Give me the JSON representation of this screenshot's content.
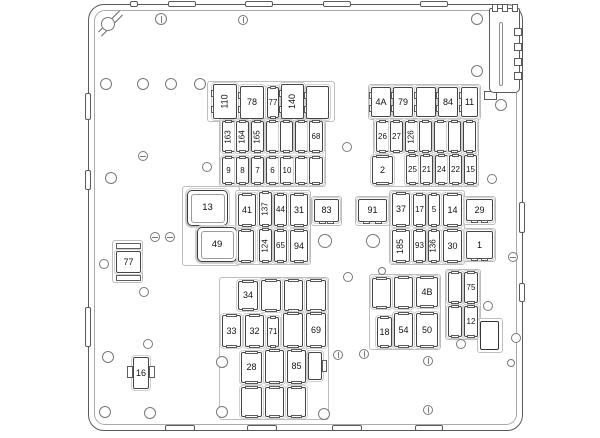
{
  "diagram": {
    "type": "fuse-box-layout",
    "canvas": {
      "width": 600,
      "height": 438
    },
    "colors": {
      "background": "#ffffff",
      "frame_stroke": "#5a5a5a",
      "frame_inner_stroke": "#a9a9a9",
      "fuse_stroke": "#454545",
      "holder_stroke": "#cfcfcf",
      "label_text": "#111111"
    },
    "frame": {
      "x": 88,
      "y": 4,
      "w": 435,
      "h": 427,
      "radius": 16
    },
    "fuse_labels_visible": [
      "110",
      "78",
      "77",
      "140",
      "163",
      "164",
      "165",
      "68",
      "9",
      "8",
      "7",
      "6",
      "10",
      "4A",
      "79",
      "84",
      "11",
      "26",
      "27",
      "126",
      "2",
      "25",
      "21",
      "24",
      "22",
      "15",
      "13",
      "41",
      "137",
      "44",
      "31",
      "83",
      "91",
      "37",
      "17",
      "5",
      "14",
      "29",
      "49",
      "124",
      "65",
      "94",
      "185",
      "93",
      "136",
      "30",
      "1",
      "77",
      "16",
      "34",
      "33",
      "32",
      "71",
      "69",
      "28",
      "85",
      "4B",
      "18",
      "54",
      "50",
      "75",
      "12"
    ],
    "fuses": [
      {
        "l": "110",
        "x": 213,
        "y": 84,
        "w": 24,
        "h": 35,
        "k": "relay",
        "r": 1
      },
      {
        "l": "78",
        "x": 240,
        "y": 86,
        "w": 24,
        "h": 33,
        "k": "relay"
      },
      {
        "l": "77",
        "x": 267,
        "y": 87,
        "w": 12,
        "h": 31,
        "k": "mini"
      },
      {
        "l": "140",
        "x": 281,
        "y": 84,
        "w": 23,
        "h": 35,
        "k": "relay",
        "r": 1
      },
      {
        "l": "",
        "x": 306,
        "y": 86,
        "w": 23,
        "h": 33,
        "k": "relay"
      },
      {
        "l": "163",
        "x": 222,
        "y": 121,
        "w": 13,
        "h": 31,
        "k": "mini",
        "r": 1
      },
      {
        "l": "164",
        "x": 236,
        "y": 121,
        "w": 13,
        "h": 31,
        "k": "mini",
        "r": 1
      },
      {
        "l": "165",
        "x": 251,
        "y": 121,
        "w": 13,
        "h": 31,
        "k": "mini",
        "r": 1
      },
      {
        "l": "",
        "x": 266,
        "y": 121,
        "w": 13,
        "h": 31,
        "k": "mini"
      },
      {
        "l": "",
        "x": 280,
        "y": 121,
        "w": 13,
        "h": 31,
        "k": "mini"
      },
      {
        "l": "",
        "x": 295,
        "y": 121,
        "w": 13,
        "h": 31,
        "k": "mini"
      },
      {
        "l": "68",
        "x": 309,
        "y": 121,
        "w": 14,
        "h": 31,
        "k": "mini"
      },
      {
        "l": "9",
        "x": 222,
        "y": 157,
        "w": 13,
        "h": 27,
        "k": "mini"
      },
      {
        "l": "8",
        "x": 236,
        "y": 157,
        "w": 13,
        "h": 27,
        "k": "mini"
      },
      {
        "l": "7",
        "x": 251,
        "y": 157,
        "w": 13,
        "h": 27,
        "k": "mini"
      },
      {
        "l": "6",
        "x": 266,
        "y": 157,
        "w": 13,
        "h": 27,
        "k": "mini"
      },
      {
        "l": "10",
        "x": 280,
        "y": 157,
        "w": 14,
        "h": 27,
        "k": "mini"
      },
      {
        "l": "",
        "x": 295,
        "y": 157,
        "w": 13,
        "h": 27,
        "k": "mini"
      },
      {
        "l": "",
        "x": 309,
        "y": 157,
        "w": 14,
        "h": 27,
        "k": "mini"
      },
      {
        "l": "4A",
        "x": 371,
        "y": 87,
        "w": 20,
        "h": 30,
        "k": "relay"
      },
      {
        "l": "79",
        "x": 393,
        "y": 87,
        "w": 20,
        "h": 30,
        "k": "relay"
      },
      {
        "l": "",
        "x": 416,
        "y": 87,
        "w": 20,
        "h": 30,
        "k": "relay"
      },
      {
        "l": "84",
        "x": 438,
        "y": 87,
        "w": 20,
        "h": 30,
        "k": "relay"
      },
      {
        "l": "11",
        "x": 461,
        "y": 87,
        "w": 17,
        "h": 30,
        "k": "relay"
      },
      {
        "l": "26",
        "x": 376,
        "y": 121,
        "w": 13,
        "h": 31,
        "k": "mini"
      },
      {
        "l": "27",
        "x": 390,
        "y": 121,
        "w": 13,
        "h": 31,
        "k": "mini"
      },
      {
        "l": "126",
        "x": 405,
        "y": 121,
        "w": 13,
        "h": 31,
        "k": "mini",
        "r": 1
      },
      {
        "l": "",
        "x": 419,
        "y": 121,
        "w": 13,
        "h": 31,
        "k": "mini"
      },
      {
        "l": "",
        "x": 434,
        "y": 121,
        "w": 13,
        "h": 31,
        "k": "mini"
      },
      {
        "l": "",
        "x": 448,
        "y": 121,
        "w": 13,
        "h": 31,
        "k": "mini"
      },
      {
        "l": "",
        "x": 463,
        "y": 121,
        "w": 13,
        "h": 31,
        "k": "mini"
      },
      {
        "l": "2",
        "x": 372,
        "y": 156,
        "w": 21,
        "h": 28,
        "k": "med"
      },
      {
        "l": "25",
        "x": 406,
        "y": 155,
        "w": 13,
        "h": 29,
        "k": "mini"
      },
      {
        "l": "21",
        "x": 420,
        "y": 155,
        "w": 13,
        "h": 29,
        "k": "mini"
      },
      {
        "l": "24",
        "x": 435,
        "y": 155,
        "w": 13,
        "h": 29,
        "k": "mini"
      },
      {
        "l": "22",
        "x": 449,
        "y": 155,
        "w": 13,
        "h": 29,
        "k": "mini"
      },
      {
        "l": "15",
        "x": 464,
        "y": 155,
        "w": 13,
        "h": 29,
        "k": "mini"
      },
      {
        "l": "13",
        "x": 187,
        "y": 190,
        "w": 41,
        "h": 36,
        "k": "big"
      },
      {
        "l": "41",
        "x": 238,
        "y": 194,
        "w": 18,
        "h": 32,
        "k": "med"
      },
      {
        "l": "137",
        "x": 259,
        "y": 192,
        "w": 13,
        "h": 34,
        "k": "mini",
        "r": 1
      },
      {
        "l": "44",
        "x": 274,
        "y": 194,
        "w": 13,
        "h": 32,
        "k": "mini"
      },
      {
        "l": "31",
        "x": 290,
        "y": 194,
        "w": 18,
        "h": 32,
        "k": "med"
      },
      {
        "l": "83",
        "x": 314,
        "y": 199,
        "w": 25,
        "h": 23,
        "k": "hrelay"
      },
      {
        "l": "91",
        "x": 358,
        "y": 199,
        "w": 29,
        "h": 23,
        "k": "hrelay"
      },
      {
        "l": "37",
        "x": 392,
        "y": 193,
        "w": 18,
        "h": 33,
        "k": "med"
      },
      {
        "l": "17",
        "x": 413,
        "y": 194,
        "w": 13,
        "h": 32,
        "k": "mini"
      },
      {
        "l": "5",
        "x": 428,
        "y": 194,
        "w": 12,
        "h": 32,
        "k": "mini"
      },
      {
        "l": "14",
        "x": 443,
        "y": 194,
        "w": 19,
        "h": 32,
        "k": "med"
      },
      {
        "l": "29",
        "x": 466,
        "y": 199,
        "w": 27,
        "h": 22,
        "k": "hrelay"
      },
      {
        "l": "49",
        "x": 197,
        "y": 227,
        "w": 40,
        "h": 35,
        "k": "big"
      },
      {
        "l": "",
        "x": 238,
        "y": 230,
        "w": 16,
        "h": 32,
        "k": "med"
      },
      {
        "l": "124",
        "x": 259,
        "y": 229,
        "w": 13,
        "h": 33,
        "k": "mini",
        "r": 1
      },
      {
        "l": "65",
        "x": 274,
        "y": 230,
        "w": 13,
        "h": 32,
        "k": "mini"
      },
      {
        "l": "94",
        "x": 290,
        "y": 230,
        "w": 18,
        "h": 32,
        "k": "med"
      },
      {
        "l": "185",
        "x": 392,
        "y": 230,
        "w": 18,
        "h": 32,
        "k": "med",
        "r": 1
      },
      {
        "l": "93",
        "x": 413,
        "y": 230,
        "w": 13,
        "h": 32,
        "k": "mini"
      },
      {
        "l": "136",
        "x": 428,
        "y": 230,
        "w": 12,
        "h": 32,
        "k": "mini",
        "r": 1
      },
      {
        "l": "30",
        "x": 443,
        "y": 230,
        "w": 19,
        "h": 32,
        "k": "med"
      },
      {
        "l": "1",
        "x": 466,
        "y": 231,
        "w": 27,
        "h": 28,
        "k": "hrelay"
      },
      {
        "l": "77",
        "x": 116,
        "y": 251,
        "w": 25,
        "h": 22,
        "k": "plain"
      },
      {
        "l": "16",
        "x": 133,
        "y": 357,
        "w": 16,
        "h": 32,
        "k": "plain"
      },
      {
        "l": "34",
        "x": 238,
        "y": 281,
        "w": 20,
        "h": 29,
        "k": "med"
      },
      {
        "l": "",
        "x": 261,
        "y": 280,
        "w": 20,
        "h": 31,
        "k": "med"
      },
      {
        "l": "",
        "x": 284,
        "y": 280,
        "w": 19,
        "h": 31,
        "k": "med"
      },
      {
        "l": "",
        "x": 306,
        "y": 280,
        "w": 20,
        "h": 31,
        "k": "med"
      },
      {
        "l": "33",
        "x": 222,
        "y": 315,
        "w": 19,
        "h": 32,
        "k": "med"
      },
      {
        "l": "32",
        "x": 245,
        "y": 315,
        "w": 19,
        "h": 32,
        "k": "med"
      },
      {
        "l": "71",
        "x": 267,
        "y": 317,
        "w": 12,
        "h": 30,
        "k": "mini"
      },
      {
        "l": "",
        "x": 283,
        "y": 313,
        "w": 20,
        "h": 34,
        "k": "med"
      },
      {
        "l": "69",
        "x": 306,
        "y": 313,
        "w": 20,
        "h": 34,
        "k": "med"
      },
      {
        "l": "28",
        "x": 241,
        "y": 352,
        "w": 21,
        "h": 31,
        "k": "med"
      },
      {
        "l": "",
        "x": 265,
        "y": 350,
        "w": 19,
        "h": 33,
        "k": "med"
      },
      {
        "l": "85",
        "x": 287,
        "y": 350,
        "w": 19,
        "h": 33,
        "k": "med"
      },
      {
        "l": "",
        "x": 308,
        "y": 352,
        "w": 14,
        "h": 28,
        "k": "plain"
      },
      {
        "l": "",
        "x": 241,
        "y": 387,
        "w": 21,
        "h": 30,
        "k": "med"
      },
      {
        "l": "",
        "x": 265,
        "y": 387,
        "w": 19,
        "h": 30,
        "k": "med"
      },
      {
        "l": "",
        "x": 287,
        "y": 387,
        "w": 19,
        "h": 30,
        "k": "med"
      },
      {
        "l": "",
        "x": 372,
        "y": 278,
        "w": 19,
        "h": 30,
        "k": "med"
      },
      {
        "l": "",
        "x": 394,
        "y": 277,
        "w": 19,
        "h": 31,
        "k": "med"
      },
      {
        "l": "4B",
        "x": 416,
        "y": 277,
        "w": 22,
        "h": 30,
        "k": "med"
      },
      {
        "l": "18",
        "x": 377,
        "y": 317,
        "w": 15,
        "h": 30,
        "k": "med"
      },
      {
        "l": "54",
        "x": 394,
        "y": 313,
        "w": 19,
        "h": 34,
        "k": "med"
      },
      {
        "l": "50",
        "x": 416,
        "y": 313,
        "w": 22,
        "h": 34,
        "k": "med"
      },
      {
        "l": "",
        "x": 448,
        "y": 272,
        "w": 14,
        "h": 31,
        "k": "mini"
      },
      {
        "l": "75",
        "x": 464,
        "y": 272,
        "w": 14,
        "h": 31,
        "k": "mini"
      },
      {
        "l": "",
        "x": 448,
        "y": 306,
        "w": 14,
        "h": 31,
        "k": "mini"
      },
      {
        "l": "12",
        "x": 464,
        "y": 306,
        "w": 14,
        "h": 31,
        "k": "mini"
      },
      {
        "l": "",
        "x": 480,
        "y": 321,
        "w": 19,
        "h": 29,
        "k": "thick"
      }
    ],
    "trays": [
      {
        "x": 207,
        "y": 81,
        "w": 128,
        "h": 41
      },
      {
        "x": 368,
        "y": 84,
        "w": 113,
        "h": 36
      },
      {
        "x": 219,
        "y": 118,
        "w": 107,
        "h": 69
      },
      {
        "x": 373,
        "y": 118,
        "w": 106,
        "h": 69
      },
      {
        "x": 182,
        "y": 186,
        "w": 58,
        "h": 80
      },
      {
        "x": 235,
        "y": 190,
        "w": 76,
        "h": 75
      },
      {
        "x": 389,
        "y": 190,
        "w": 76,
        "h": 75
      },
      {
        "x": 311,
        "y": 196,
        "w": 31,
        "h": 30
      },
      {
        "x": 355,
        "y": 196,
        "w": 35,
        "h": 30
      },
      {
        "x": 463,
        "y": 196,
        "w": 33,
        "h": 29
      },
      {
        "x": 463,
        "y": 228,
        "w": 33,
        "h": 34
      },
      {
        "x": 112,
        "y": 240,
        "w": 31,
        "h": 43
      },
      {
        "x": 219,
        "y": 277,
        "w": 110,
        "h": 143
      },
      {
        "x": 369,
        "y": 274,
        "w": 72,
        "h": 76
      },
      {
        "x": 445,
        "y": 269,
        "w": 36,
        "h": 71
      },
      {
        "x": 477,
        "y": 318,
        "w": 26,
        "h": 35
      }
    ],
    "bars": [
      {
        "x": 116,
        "y": 243,
        "w": 25,
        "h": 6
      },
      {
        "x": 116,
        "y": 275,
        "w": 25,
        "h": 6
      },
      {
        "x": 127,
        "y": 366,
        "w": 6,
        "h": 12
      },
      {
        "x": 149,
        "y": 366,
        "w": 6,
        "h": 12
      },
      {
        "x": 322,
        "y": 360,
        "w": 5,
        "h": 12
      },
      {
        "x": 484,
        "y": 91,
        "w": 13,
        "h": 9
      }
    ],
    "holes": [
      {
        "x": 108,
        "y": 24,
        "r": 7
      },
      {
        "x": 161,
        "y": 19,
        "r": 6,
        "s": "v"
      },
      {
        "x": 243,
        "y": 20,
        "r": 5,
        "s": "v"
      },
      {
        "x": 477,
        "y": 19,
        "r": 6
      },
      {
        "x": 477,
        "y": 71,
        "r": 6
      },
      {
        "x": 106,
        "y": 84,
        "r": 6
      },
      {
        "x": 143,
        "y": 84,
        "r": 6
      },
      {
        "x": 171,
        "y": 84,
        "r": 6
      },
      {
        "x": 200,
        "y": 84,
        "r": 6
      },
      {
        "x": 143,
        "y": 156,
        "r": 5,
        "s": "h"
      },
      {
        "x": 111,
        "y": 178,
        "r": 6
      },
      {
        "x": 207,
        "y": 167,
        "r": 5
      },
      {
        "x": 347,
        "y": 147,
        "r": 5
      },
      {
        "x": 501,
        "y": 105,
        "r": 6
      },
      {
        "x": 492,
        "y": 179,
        "r": 5
      },
      {
        "x": 155,
        "y": 237,
        "r": 5,
        "s": "h"
      },
      {
        "x": 170,
        "y": 237,
        "r": 5,
        "s": "h"
      },
      {
        "x": 104,
        "y": 264,
        "r": 5
      },
      {
        "x": 325,
        "y": 241,
        "r": 7
      },
      {
        "x": 373,
        "y": 241,
        "r": 7
      },
      {
        "x": 144,
        "y": 292,
        "r": 5
      },
      {
        "x": 348,
        "y": 277,
        "r": 5
      },
      {
        "x": 382,
        "y": 271,
        "r": 4
      },
      {
        "x": 488,
        "y": 306,
        "r": 5
      },
      {
        "x": 461,
        "y": 344,
        "r": 5
      },
      {
        "x": 516,
        "y": 338,
        "r": 5
      },
      {
        "x": 511,
        "y": 363,
        "r": 4
      },
      {
        "x": 513,
        "y": 257,
        "r": 5,
        "s": "h"
      },
      {
        "x": 108,
        "y": 357,
        "r": 6
      },
      {
        "x": 148,
        "y": 344,
        "r": 5
      },
      {
        "x": 222,
        "y": 362,
        "r": 6
      },
      {
        "x": 338,
        "y": 355,
        "r": 5,
        "s": "v"
      },
      {
        "x": 364,
        "y": 354,
        "r": 5,
        "s": "v"
      },
      {
        "x": 428,
        "y": 361,
        "r": 5,
        "s": "v"
      },
      {
        "x": 428,
        "y": 410,
        "r": 5,
        "s": "v"
      },
      {
        "x": 105,
        "y": 412,
        "r": 6
      },
      {
        "x": 150,
        "y": 413,
        "r": 6
      },
      {
        "x": 222,
        "y": 412,
        "r": 6
      },
      {
        "x": 324,
        "y": 414,
        "r": 6
      }
    ],
    "tabs": {
      "top": [
        [
          130,
          8
        ],
        [
          168,
          28
        ],
        [
          245,
          28
        ],
        [
          323,
          28
        ],
        [
          420,
          28
        ]
      ],
      "bottom": [
        [
          165,
          30
        ],
        [
          247,
          30
        ],
        [
          332,
          30
        ],
        [
          415,
          28
        ]
      ],
      "left": [
        [
          93,
          27
        ],
        [
          170,
          20
        ],
        [
          307,
          40
        ]
      ],
      "right": [
        [
          202,
          31
        ],
        [
          283,
          19
        ]
      ]
    },
    "comb": {
      "block": {
        "x": 489,
        "y": 8,
        "w": 31,
        "h": 85
      },
      "teeth_top": [
        [
          492,
          6
        ],
        [
          502,
          6
        ],
        [
          512,
          6
        ]
      ],
      "teeth_right_y": [
        28,
        43,
        58,
        72
      ],
      "slot": {
        "x": 499,
        "y": 22,
        "w": 4,
        "h": 64
      }
    }
  }
}
